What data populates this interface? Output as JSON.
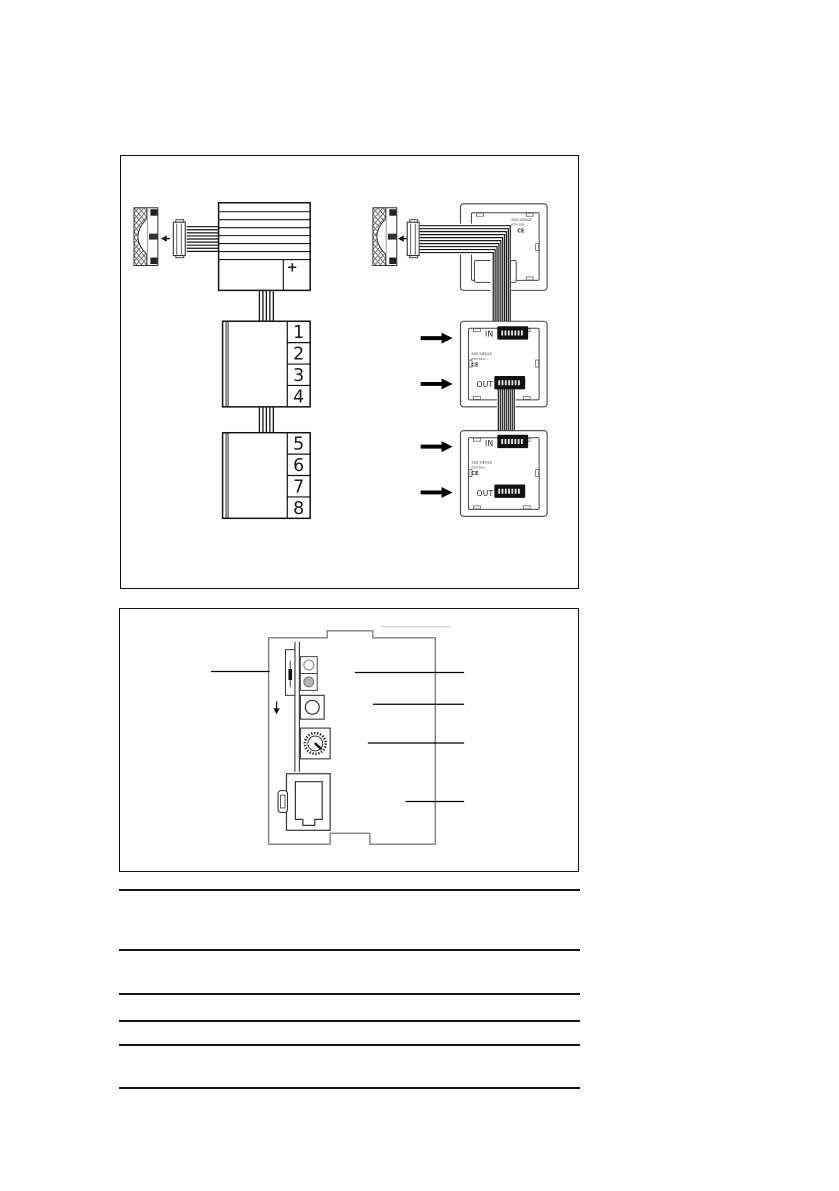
{
  "document": {
    "kind": "installation-manual-page",
    "background": "#ffffff",
    "line_color": "#1a1a1a",
    "device_outline_color": "#7f7f7f"
  },
  "figure1": {
    "left_diagram": {
      "terminal_numbers_top": [
        "1",
        "2",
        "3",
        "4"
      ],
      "terminal_numbers_bottom": [
        "5",
        "6",
        "7",
        "8"
      ],
      "plus_mark": "+"
    },
    "right_diagram": {
      "arrow_count": 4,
      "plates": [
        {
          "print1": "SSS SIEDLE",
          "print2": "BTM 650-...",
          "ce": "CE"
        },
        {
          "in": "IN",
          "out": "OUT",
          "print1": "SSS SIEDLE",
          "print2": "BTM 650-...",
          "ce": "CE"
        },
        {
          "in": "IN",
          "out": "OUT",
          "print1": "SSS SIEDLE",
          "print2": "BTM 650-...",
          "ce": "CE"
        }
      ]
    }
  },
  "figure2": {
    "callout_count": 5
  },
  "bottom_rules": {
    "count": 6
  }
}
